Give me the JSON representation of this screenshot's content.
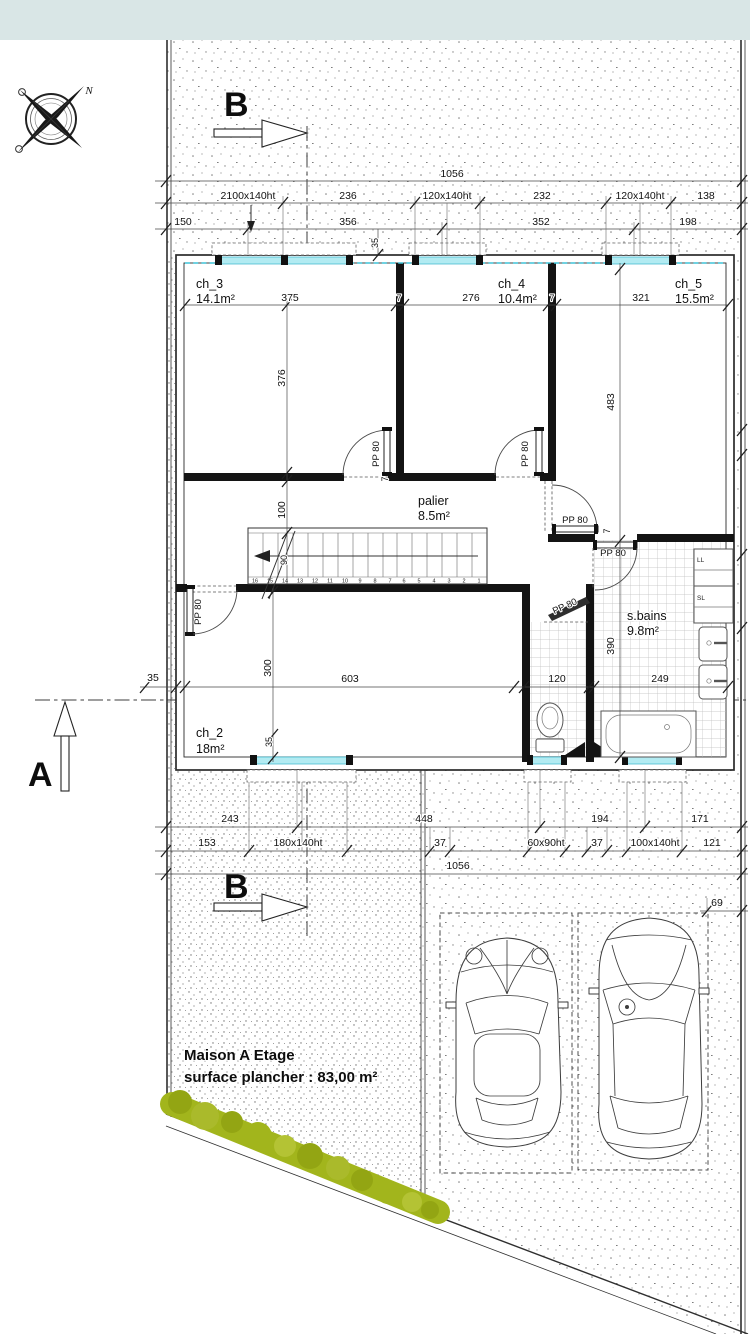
{
  "plan": {
    "title_line1": "Maison A  Etage",
    "title_line2": "surface plancher : 83,00 m²"
  },
  "sections": {
    "a": "A",
    "b_top": "B",
    "b_bottom": "B"
  },
  "compass": {
    "north": "N"
  },
  "rooms": {
    "ch3": {
      "name": "ch_3",
      "area": "14.1m²"
    },
    "ch4": {
      "name": "ch_4",
      "area": "10.4m²"
    },
    "ch5": {
      "name": "ch_5",
      "area": "15.5m²"
    },
    "ch2": {
      "name": "ch_2",
      "area": "18m²"
    },
    "palier": {
      "name": "palier",
      "area": "8.5m²"
    },
    "sbains": {
      "name": "s.bains",
      "area": "9.8m²"
    }
  },
  "appliances": {
    "washer": "LL",
    "dryer": "SL"
  },
  "doors": {
    "pp80": "PP 80"
  },
  "stairs": {
    "numbers": [
      "16",
      "15",
      "14",
      "13",
      "12",
      "11",
      "10",
      "9",
      "8",
      "7",
      "6",
      "5",
      "4",
      "3",
      "2",
      "1"
    ],
    "width_label": "90"
  },
  "dims": {
    "top": {
      "overall": "1056",
      "row2": [
        "2100x140ht",
        "236",
        "120x140ht",
        "232",
        "120x140ht",
        "138"
      ],
      "row3": [
        "150",
        "356",
        "352",
        "198"
      ],
      "wall": "35"
    },
    "bottom": {
      "row1": [
        "243",
        "448",
        "194",
        "171"
      ],
      "row2": [
        "153",
        "180x140ht",
        "37",
        "60x90ht",
        "37",
        "100x140ht",
        "121"
      ],
      "overall": "1056",
      "parking": "69"
    },
    "interior": {
      "ch3_w": "375",
      "t1": "7",
      "ch4_w": "276",
      "t2": "7",
      "ch5_w": "321",
      "ch3_h": "376",
      "ch5_h": "483",
      "palier_d": "100",
      "ch2_h": "300",
      "ch2_w": "603",
      "wc_w": "120",
      "bath_w": "249",
      "sbains_h": "390",
      "wall_l": "35",
      "win_off": "35",
      "t3": "7",
      "t4": "7"
    }
  },
  "colors": {
    "band": "#d9e6e6",
    "glazing": "#b2ebf2",
    "hedge": "#a2b51c"
  }
}
